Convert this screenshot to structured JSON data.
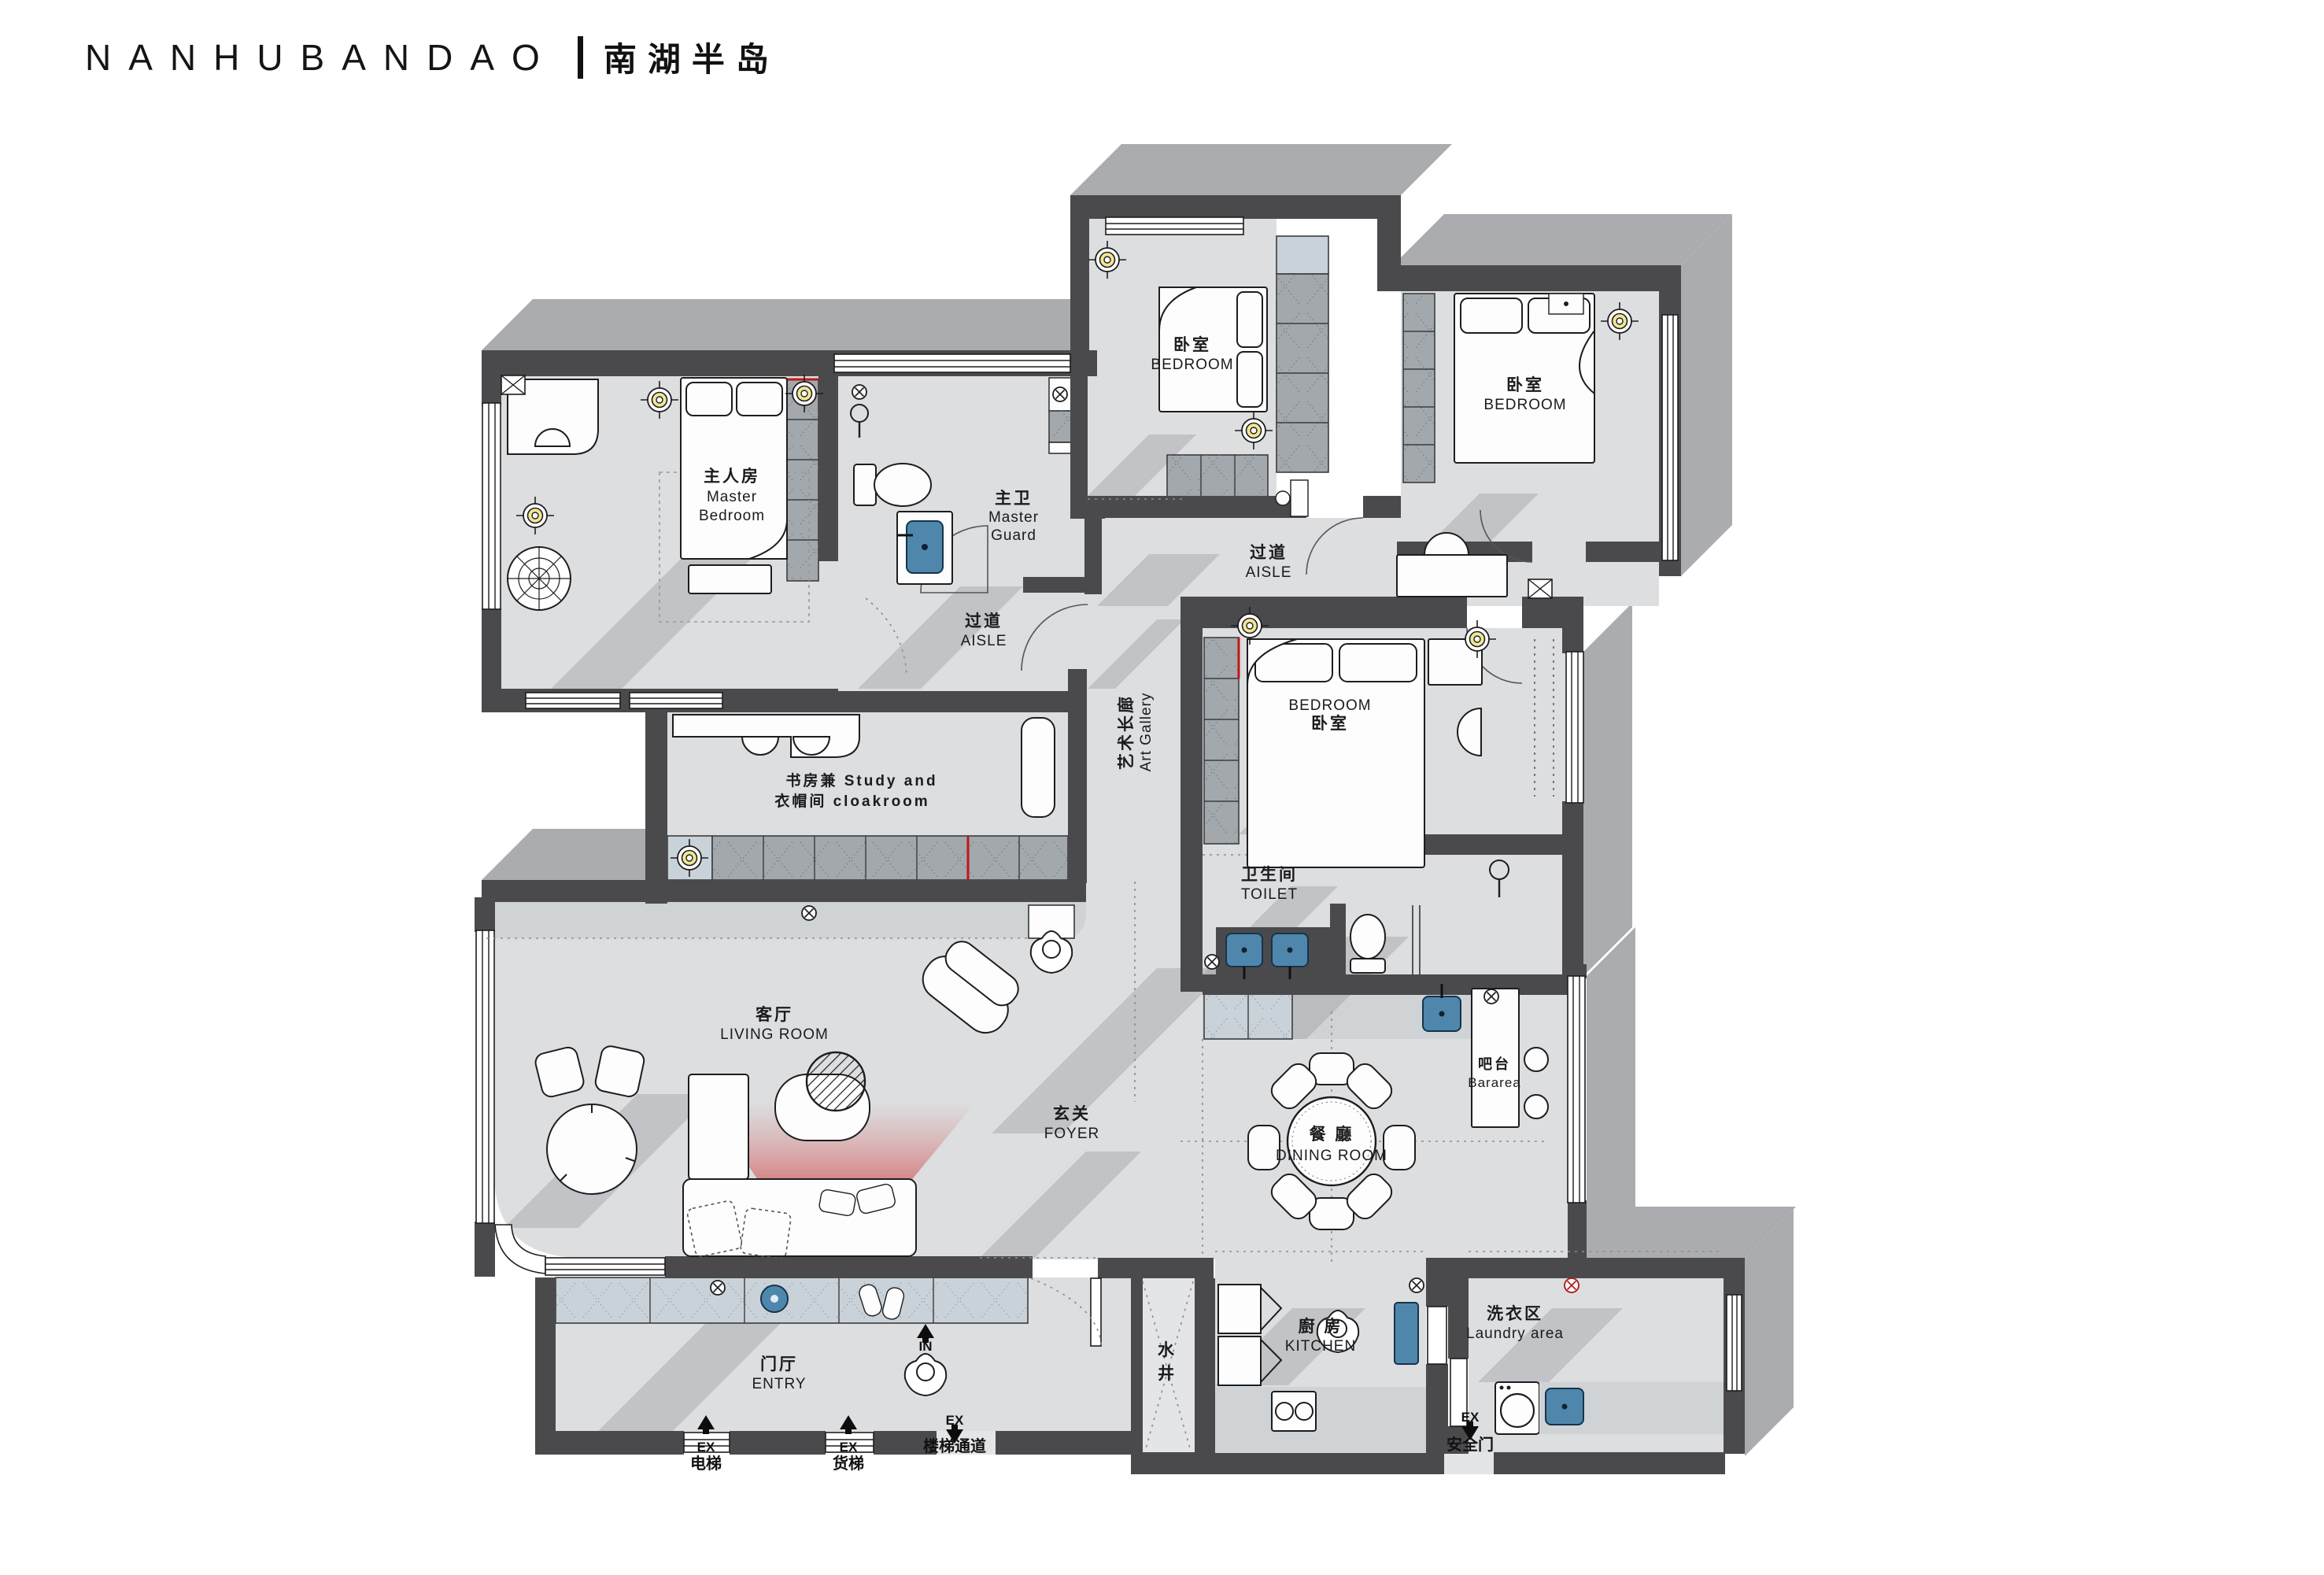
{
  "title": {
    "latin": "NANHUBANDAO",
    "divider": "|",
    "chinese": "南湖半岛"
  },
  "colors": {
    "wall": "#4a4a4d",
    "floor": "#dcdee0",
    "shadow": "#aaacaf",
    "accent_red": "#c01616",
    "light_yellow": "#f1e793",
    "sink_blue": "#4f87ac"
  },
  "rooms": {
    "master_bedroom": {
      "zh": "主人房",
      "en1": "Master",
      "en2": "Bedroom"
    },
    "master_guard": {
      "zh": "主卫",
      "en1": "Master",
      "en2": "Guard"
    },
    "aisle_left": {
      "zh": "过道",
      "en": "AISLE"
    },
    "bedroom_top_middle": {
      "zh": "卧室",
      "en": "BEDROOM"
    },
    "bedroom_top_right": {
      "zh": "卧室",
      "en": "BEDROOM"
    },
    "aisle_right": {
      "zh": "过道",
      "en": "AISLE"
    },
    "bedroom_right": {
      "en": "BEDROOM",
      "zh": "卧室"
    },
    "art_gallery": {
      "zh": "艺术长廊",
      "en": "Art  Gallery"
    },
    "study": {
      "line1": "书房兼 Study and",
      "line2": "衣帽间 cloakroom"
    },
    "toilet": {
      "zh": "卫生间",
      "en": "TOILET"
    },
    "living_room": {
      "zh": "客厅",
      "en": "LIVING  ROOM"
    },
    "foyer": {
      "zh": "玄关",
      "en": "FOYER"
    },
    "bar_area": {
      "zh": "吧台",
      "en": "Bararea"
    },
    "dining_room": {
      "zh": "餐 廳",
      "en": "DINING  ROOM"
    },
    "kitchen": {
      "zh": "廚 房",
      "en": "KITCHEN"
    },
    "laundry": {
      "zh": "洗衣区",
      "en": "Laundry area"
    },
    "entry": {
      "zh": "门厅",
      "en": "ENTRY"
    },
    "water_well": {
      "char1": "水",
      "char2": "井"
    }
  },
  "markers": {
    "in": "IN",
    "ex": "EX",
    "elevator": "电梯",
    "freight_elevator": "货梯",
    "stair_passage": "楼梯通道",
    "safety_door": "安全门"
  }
}
